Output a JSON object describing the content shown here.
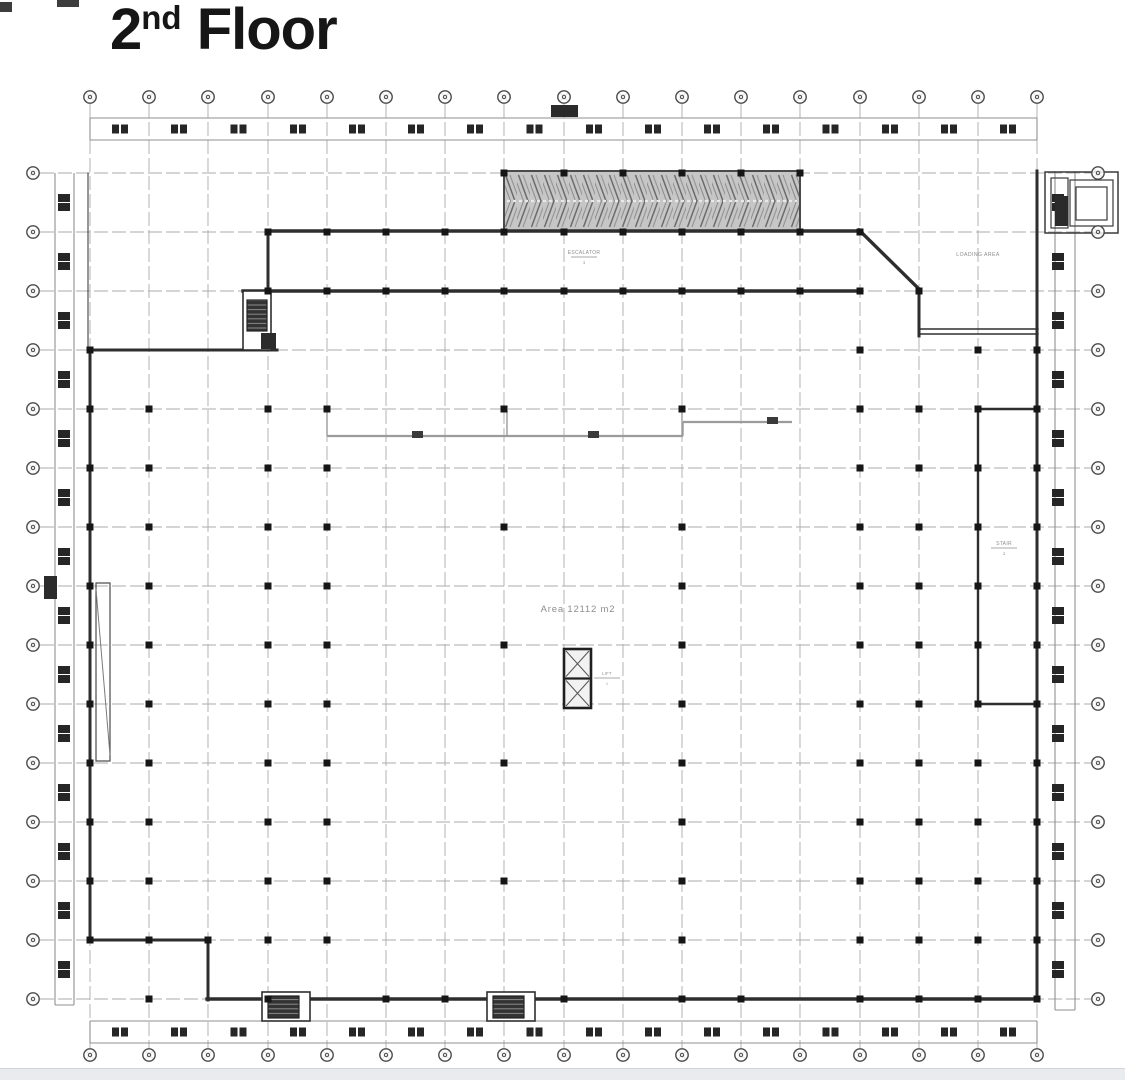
{
  "title": {
    "num": "2",
    "sup": "nd",
    "rest": " Floor"
  },
  "colors": {
    "paper": "#ffffff",
    "ink": "#161616",
    "wall": "#2e2e2e",
    "grid": "#ababab",
    "strip_line": "#8f8f8f",
    "column_fill": "#262626",
    "bubble": "#4a4a4a",
    "label": "#8e8e8e",
    "partition": "#9b9b9b",
    "hatch_bg": "#c6c6c6",
    "footer": "#e9ebee"
  },
  "grid": {
    "cols": [
      90,
      149,
      208,
      268,
      327,
      386,
      445,
      504,
      564,
      623,
      682,
      741,
      800,
      860,
      919,
      978,
      1037
    ],
    "rows": [
      173,
      232,
      291,
      350,
      409,
      468,
      527,
      586,
      645,
      704,
      763,
      822,
      881,
      940,
      999
    ],
    "v_top": 104,
    "v_bottom": 1048,
    "h_left": 40,
    "h_right": 1091,
    "top_bubble_y": 97,
    "bottom_bubble_y": 1055,
    "left_bubble_x": 33,
    "right_bubble_x": 1098,
    "bubble_r": 6.2
  },
  "strips": {
    "top": {
      "lines": [
        [
          90,
          118,
          1037,
          118
        ],
        [
          90,
          140,
          1037,
          140
        ],
        [
          90,
          118,
          90,
          140
        ],
        [
          1037,
          118,
          1037,
          140
        ]
      ],
      "col_y": 124.5
    },
    "bottom": {
      "lines": [
        [
          90,
          1021,
          1037,
          1021
        ],
        [
          90,
          1043,
          1037,
          1043
        ],
        [
          90,
          1021,
          90,
          1043
        ],
        [
          1037,
          1021,
          1037,
          1043
        ]
      ],
      "col_y": 1027.5
    },
    "left": {
      "lines": [
        [
          55,
          173,
          55,
          1005
        ],
        [
          74,
          173,
          74,
          1005
        ],
        [
          55,
          1005,
          74,
          1005
        ]
      ],
      "col_x": 58
    },
    "right": {
      "lines": [
        [
          1055,
          171,
          1055,
          1010
        ],
        [
          1075,
          171,
          1075,
          1010
        ],
        [
          1055,
          1010,
          1075,
          1010
        ]
      ],
      "col_x": 1052
    }
  },
  "walls": [
    [
      268,
      231,
      861,
      231,
      3.4
    ],
    [
      859,
      230,
      920,
      290,
      3.4
    ],
    [
      919,
      291,
      919,
      336,
      3.0
    ],
    [
      268,
      231,
      268,
      291,
      3.0
    ],
    [
      243,
      291,
      861,
      291,
      3.4
    ],
    [
      90,
      350,
      277,
      350,
      3.0
    ],
    [
      90,
      348,
      90,
      941,
      3.0
    ],
    [
      90,
      940,
      209,
      940,
      3.0
    ],
    [
      208,
      940,
      208,
      1000,
      3.0
    ],
    [
      207,
      999,
      1038,
      999,
      3.4
    ],
    [
      1037,
      171,
      1037,
      1000,
      3.0
    ],
    [
      919,
      329,
      1038,
      329,
      1.4
    ],
    [
      919,
      334,
      1038,
      334,
      1.4
    ],
    [
      978,
      409,
      978,
      704,
      2.4
    ],
    [
      976,
      409,
      1038,
      409,
      2.4
    ],
    [
      976,
      704,
      1038,
      704,
      2.4
    ],
    [
      88,
      173,
      88,
      350,
      1.0
    ]
  ],
  "partition": {
    "segs": [
      [
        327,
        411,
        327,
        436,
        1.4
      ],
      [
        507,
        411,
        507,
        436,
        1.4
      ],
      [
        682,
        411,
        682,
        436,
        1.4
      ],
      [
        327,
        436,
        683,
        436,
        2.2
      ],
      [
        683,
        422,
        683,
        436,
        1.4
      ],
      [
        683,
        422,
        792,
        422,
        2.2
      ]
    ],
    "ticks": [
      [
        412,
        431,
        11,
        7
      ],
      [
        588,
        431,
        11,
        7
      ],
      [
        767,
        417,
        11,
        7
      ]
    ]
  },
  "dots": [
    {
      "col": 0,
      "rows": [
        3,
        4,
        5,
        6,
        7,
        8,
        9,
        10,
        11,
        12,
        13
      ]
    },
    {
      "col": 1,
      "rows": [
        4,
        5,
        6,
        7,
        8,
        9,
        10,
        11,
        12,
        13,
        14
      ]
    },
    {
      "col": 2,
      "rows": [
        13
      ]
    },
    {
      "col": 3,
      "rows": [
        1,
        2,
        4,
        5,
        6,
        7,
        8,
        9,
        10,
        11,
        12,
        13,
        14
      ]
    },
    {
      "col": 4,
      "rows": [
        1,
        2,
        4,
        5,
        6,
        7,
        8,
        9,
        10,
        11,
        12,
        13
      ]
    },
    {
      "col": 5,
      "rows": [
        1,
        2,
        14
      ]
    },
    {
      "col": 6,
      "rows": [
        1,
        2,
        14
      ]
    },
    {
      "col": 7,
      "rows": [
        0,
        1,
        2,
        4,
        6,
        8,
        10,
        12
      ]
    },
    {
      "col": 8,
      "rows": [
        0,
        1,
        2,
        14
      ]
    },
    {
      "col": 9,
      "rows": [
        0,
        1,
        2
      ]
    },
    {
      "col": 10,
      "rows": [
        0,
        1,
        2,
        4,
        6,
        7,
        8,
        9,
        10,
        11,
        12,
        13,
        14
      ]
    },
    {
      "col": 11,
      "rows": [
        0,
        1,
        2,
        14
      ]
    },
    {
      "col": 12,
      "rows": [
        0,
        1,
        2
      ]
    },
    {
      "col": 13,
      "rows": [
        1,
        2,
        3,
        4,
        5,
        6,
        7,
        8,
        9,
        10,
        11,
        12,
        13,
        14
      ]
    },
    {
      "col": 14,
      "rows": [
        2,
        4,
        5,
        6,
        7,
        8,
        9,
        10,
        11,
        12,
        13,
        14
      ]
    },
    {
      "col": 15,
      "rows": [
        3,
        4,
        5,
        6,
        7,
        8,
        9,
        10,
        11,
        12,
        13,
        14
      ]
    },
    {
      "col": 16,
      "rows": [
        3,
        4,
        5,
        6,
        7,
        8,
        9,
        10,
        11,
        12,
        13,
        14
      ]
    }
  ],
  "shapes": {
    "hatch_box": {
      "x": 504,
      "y": 171,
      "w": 296,
      "h": 60
    },
    "stair_tl": {
      "outer": [
        243,
        291,
        28,
        59
      ],
      "hatch": [
        247,
        300,
        20,
        31
      ],
      "foot": [
        261,
        333,
        15,
        16
      ]
    },
    "stair_b1": {
      "outer": [
        262,
        992,
        48,
        29
      ],
      "hatch": [
        268,
        996,
        31,
        22
      ]
    },
    "stair_b2": {
      "outer": [
        487,
        992,
        48,
        29
      ],
      "hatch": [
        493,
        996,
        31,
        22
      ]
    },
    "elevator": {
      "x": 564,
      "y": 649,
      "w": 27,
      "h": 59
    },
    "tr_unit": {
      "outer": [
        1045,
        172,
        73,
        61
      ],
      "rects": [
        [
          1051,
          178,
          17,
          50
        ],
        [
          1070,
          180,
          43,
          46
        ],
        [
          1076,
          187,
          31,
          33
        ]
      ],
      "dark": [
        1055,
        196,
        13,
        30
      ]
    },
    "ramp": [
      96,
      583,
      14,
      178
    ],
    "entry_blob": [
      44,
      576,
      13,
      23
    ],
    "section_marker": [
      551,
      105,
      27,
      12
    ],
    "artifacts": [
      [
        0,
        2,
        12,
        10
      ],
      [
        57,
        0,
        22,
        7
      ]
    ]
  },
  "texts": [
    {
      "id": "area-label",
      "text": "Area 12112 m2",
      "x": 578,
      "y": 612,
      "size": 9.5,
      "ls": 0.8
    },
    {
      "id": "loading-area-label",
      "text": "LOADING AREA",
      "x": 978,
      "y": 256,
      "size": 5.2,
      "ls": 0.4
    }
  ],
  "tags": [
    {
      "id": "escalator-tag",
      "text": "ESCALATOR",
      "x": 584,
      "y": 254,
      "size": 5
    },
    {
      "id": "stair-room-tag",
      "text": "STAIR",
      "x": 1004,
      "y": 545,
      "size": 5
    },
    {
      "id": "lift-tag",
      "text": "LIFT",
      "x": 607,
      "y": 675,
      "size": 4.2
    }
  ]
}
